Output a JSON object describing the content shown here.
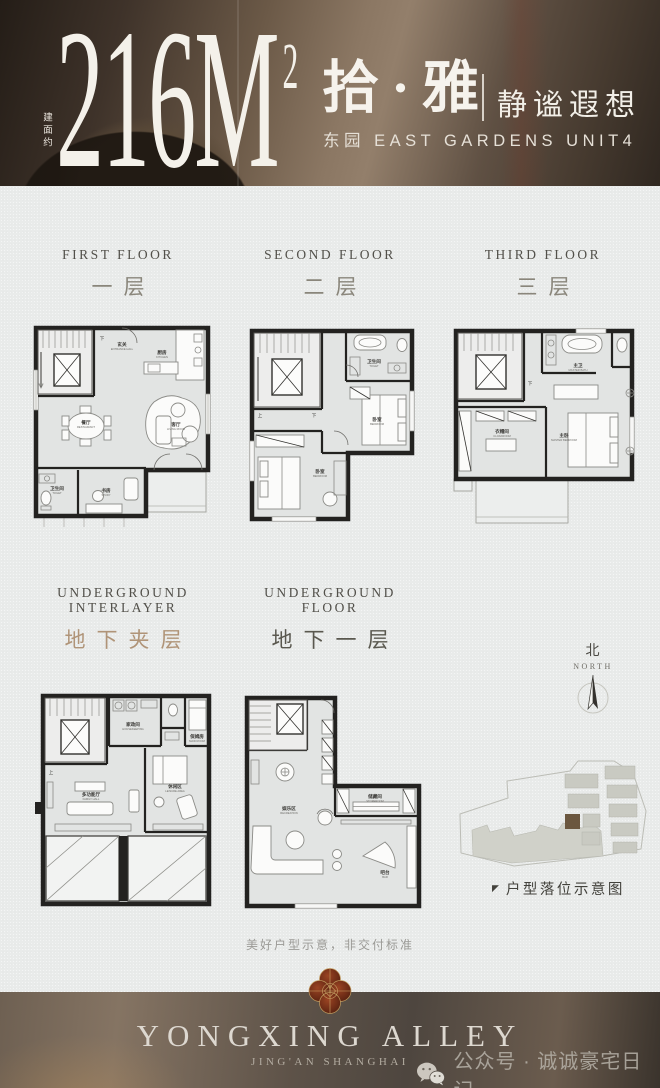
{
  "header": {
    "area_label": "建面约",
    "area_value": "216M",
    "area_sup": "2",
    "name_cn": "拾·雅",
    "tagline": "静谧遐想",
    "subline": "东园 EAST GARDENS UNIT4"
  },
  "floors": [
    {
      "label_en": "FIRST FLOOR",
      "label_cn": "一层",
      "rooms": [
        {
          "cn": "玄关",
          "en": "ENTRANCE HALL"
        },
        {
          "cn": "厨房",
          "en": "KITCHEN"
        },
        {
          "cn": "餐厅",
          "en": "RESTAURANT"
        },
        {
          "cn": "客厅",
          "en": "LIVING ROOM"
        },
        {
          "cn": "卫生间",
          "en": "TOILET"
        },
        {
          "cn": "书房",
          "en": "STUDY"
        }
      ]
    },
    {
      "label_en": "SECOND FLOOR",
      "label_cn": "二层",
      "rooms": [
        {
          "cn": "卫生间",
          "en": "TOILET"
        },
        {
          "cn": "卧室",
          "en": "BEDROOM"
        },
        {
          "cn": "卧室",
          "en": "BEDROOM"
        }
      ]
    },
    {
      "label_en": "THIRD FLOOR",
      "label_cn": "三层",
      "rooms": [
        {
          "cn": "主卫",
          "en": "MASTER BATH"
        },
        {
          "cn": "主卧",
          "en": "MASTER BEDROOM"
        },
        {
          "cn": "衣帽间",
          "en": "CLOAKROOM"
        }
      ]
    },
    {
      "label_en": "UNDERGROUND INTERLAYER",
      "label_cn": "地下夹层",
      "rooms": [
        {
          "cn": "家政间",
          "en": "HOUSEKEEPING"
        },
        {
          "cn": "保姆房",
          "en": "MAID ROOM"
        },
        {
          "cn": "多功能厅",
          "en": "FAMILY HALL"
        },
        {
          "cn": "休闲区",
          "en": "LEISURE AREA"
        }
      ]
    },
    {
      "label_en": "UNDERGROUND FLOOR",
      "label_cn": "地下一层",
      "rooms": [
        {
          "cn": "储藏间",
          "en": "STOREROOM"
        },
        {
          "cn": "吧台",
          "en": "BAR"
        },
        {
          "cn": "娱乐区",
          "en": "RECREATION"
        }
      ]
    }
  ],
  "plan_glyphs": {
    "up": "上",
    "down": "下"
  },
  "compass": {
    "cn": "北",
    "en": "NORTH"
  },
  "siteplan": {
    "caption": "户型落位示意图"
  },
  "icons": {
    "flag": "◤"
  },
  "disclaimer": "美好户型示意，非交付标准",
  "footer": {
    "brand": "YONGXING ALLEY",
    "sub": "JING'AN SHANGHAI",
    "watermark": "公众号 · 诚诚豪宅日记"
  },
  "colors": {
    "paper": "#e9ebea",
    "header_dark": "#3f332a",
    "wall_ink": "#232220",
    "floor_fill": "#e3e5e4",
    "label_gray": "#8a867b",
    "label_tan": "#b09478",
    "label_dark": "#5a584f",
    "site_highlight": "#6b573f",
    "logo_red": "#74301b",
    "logo_gold": "#c09a5e",
    "footer_dark": "#4e463f"
  }
}
